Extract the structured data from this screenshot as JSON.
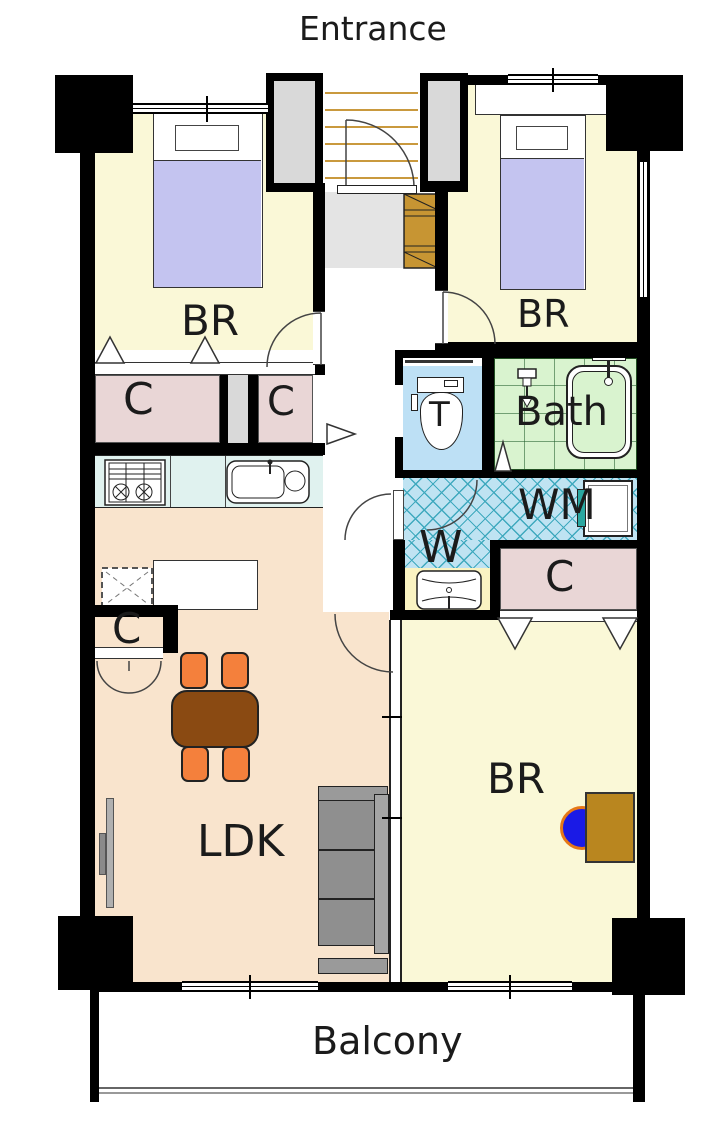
{
  "plan": {
    "entrance": "Entrance",
    "balcony": "Balcony",
    "bedroom_top_left": "BR",
    "bedroom_top_right": "BR",
    "bedroom_bottom": "BR",
    "ldk": "LDK",
    "bath": "Bath",
    "toilet": "T",
    "washroom": "W",
    "washing_machine": "WM",
    "closet_top_left": "C",
    "closet_top_mid": "C",
    "closet_ldk": "C",
    "closet_bottom": "C",
    "colors": {
      "wall": "#000000",
      "room_yellow": "#FAF8D7",
      "room_peach": "#F9E4CD",
      "closet_pink": "#E9D6D6",
      "bed_lavender": "#C4C4F0",
      "toilet_blue": "#BDE0F5",
      "bath_green": "#D9F3CF",
      "kitchen_counter": "#E0F2EF",
      "washroom_tile": "#BFE3F2",
      "tile_line_teal": "#3FA9BE",
      "vanity_yellow": "#FAF3C2",
      "entry_gray": "#E4E4E4",
      "column_gray": "#D9D9D9",
      "step_tan": "#C9993E",
      "shoe_cabinet_brown": "#C79533",
      "desk_brown": "#B9861F",
      "table_brown": "#8A4A12",
      "chair_orange": "#F4803C",
      "sofa_gray": "#8F8F8F",
      "desk_chair_blue": "#1A1AE6"
    }
  }
}
